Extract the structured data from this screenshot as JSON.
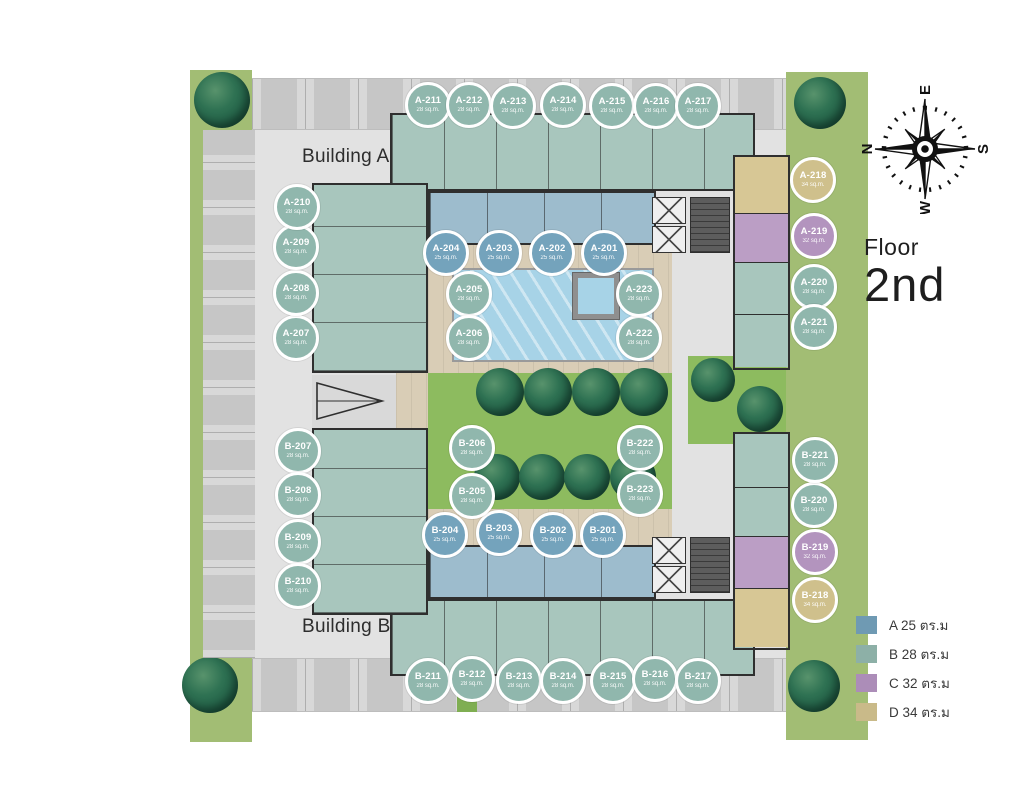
{
  "floor_label": {
    "line1": "Floor",
    "line2": "2nd"
  },
  "buildings": {
    "building_a": "Building A",
    "building_b": "Building B"
  },
  "compass": {
    "n": "N",
    "e": "E",
    "s": "S",
    "w": "W"
  },
  "legend": [
    {
      "code": "A",
      "label": "A 25 ตร.ม",
      "color": "#6f9ab3"
    },
    {
      "code": "B",
      "label": "B 28 ตร.ม",
      "color": "#8db0a7"
    },
    {
      "code": "C",
      "label": "C 32 ตร.ม",
      "color": "#ac8db8"
    },
    {
      "code": "D",
      "label": "D 34 ตร.ม",
      "color": "#c9ba89"
    }
  ],
  "unit_types": {
    "A": {
      "area": "25 sq.m.",
      "color": "#74a3bc"
    },
    "B": {
      "area": "28 sq.m.",
      "color": "#90b7ad"
    },
    "C": {
      "area": "32 sq.m.",
      "color": "#b394be"
    },
    "D": {
      "area": "34 sq.m.",
      "color": "#cfc08c"
    }
  },
  "units": [
    {
      "id": "A-201",
      "type": "A",
      "x": 604,
      "y": 253
    },
    {
      "id": "A-202",
      "type": "A",
      "x": 552,
      "y": 253
    },
    {
      "id": "A-203",
      "type": "A",
      "x": 499,
      "y": 253
    },
    {
      "id": "A-204",
      "type": "A",
      "x": 446,
      "y": 253
    },
    {
      "id": "A-205",
      "type": "B",
      "x": 469,
      "y": 294
    },
    {
      "id": "A-206",
      "type": "B",
      "x": 469,
      "y": 338
    },
    {
      "id": "A-207",
      "type": "B",
      "x": 296,
      "y": 338
    },
    {
      "id": "A-208",
      "type": "B",
      "x": 296,
      "y": 293
    },
    {
      "id": "A-209",
      "type": "B",
      "x": 296,
      "y": 247
    },
    {
      "id": "A-210",
      "type": "B",
      "x": 297,
      "y": 207
    },
    {
      "id": "A-211",
      "type": "B",
      "x": 428,
      "y": 105
    },
    {
      "id": "A-212",
      "type": "B",
      "x": 469,
      "y": 105
    },
    {
      "id": "A-213",
      "type": "B",
      "x": 513,
      "y": 106
    },
    {
      "id": "A-214",
      "type": "B",
      "x": 563,
      "y": 105
    },
    {
      "id": "A-215",
      "type": "B",
      "x": 612,
      "y": 106
    },
    {
      "id": "A-216",
      "type": "B",
      "x": 656,
      "y": 106
    },
    {
      "id": "A-217",
      "type": "B",
      "x": 698,
      "y": 106
    },
    {
      "id": "A-218",
      "type": "D",
      "x": 813,
      "y": 180
    },
    {
      "id": "A-219",
      "type": "C",
      "x": 814,
      "y": 236
    },
    {
      "id": "A-220",
      "type": "B",
      "x": 814,
      "y": 287
    },
    {
      "id": "A-221",
      "type": "B",
      "x": 814,
      "y": 327
    },
    {
      "id": "A-222",
      "type": "B",
      "x": 639,
      "y": 338
    },
    {
      "id": "A-223",
      "type": "B",
      "x": 639,
      "y": 294
    },
    {
      "id": "B-201",
      "type": "A",
      "x": 603,
      "y": 535
    },
    {
      "id": "B-202",
      "type": "A",
      "x": 553,
      "y": 535
    },
    {
      "id": "B-203",
      "type": "A",
      "x": 499,
      "y": 533
    },
    {
      "id": "B-204",
      "type": "A",
      "x": 445,
      "y": 535
    },
    {
      "id": "B-205",
      "type": "B",
      "x": 472,
      "y": 496
    },
    {
      "id": "B-206",
      "type": "B",
      "x": 472,
      "y": 448
    },
    {
      "id": "B-207",
      "type": "B",
      "x": 298,
      "y": 451
    },
    {
      "id": "B-208",
      "type": "B",
      "x": 298,
      "y": 495
    },
    {
      "id": "B-209",
      "type": "B",
      "x": 298,
      "y": 542
    },
    {
      "id": "B-210",
      "type": "B",
      "x": 298,
      "y": 586
    },
    {
      "id": "B-211",
      "type": "B",
      "x": 428,
      "y": 681
    },
    {
      "id": "B-212",
      "type": "B",
      "x": 472,
      "y": 679
    },
    {
      "id": "B-213",
      "type": "B",
      "x": 519,
      "y": 681
    },
    {
      "id": "B-214",
      "type": "B",
      "x": 563,
      "y": 681
    },
    {
      "id": "B-215",
      "type": "B",
      "x": 613,
      "y": 681
    },
    {
      "id": "B-216",
      "type": "B",
      "x": 655,
      "y": 679
    },
    {
      "id": "B-217",
      "type": "B",
      "x": 698,
      "y": 681
    },
    {
      "id": "B-218",
      "type": "D",
      "x": 815,
      "y": 600
    },
    {
      "id": "B-219",
      "type": "C",
      "x": 815,
      "y": 552
    },
    {
      "id": "B-220",
      "type": "B",
      "x": 814,
      "y": 505
    },
    {
      "id": "B-221",
      "type": "B",
      "x": 815,
      "y": 460
    },
    {
      "id": "B-222",
      "type": "B",
      "x": 640,
      "y": 448
    },
    {
      "id": "B-223",
      "type": "B",
      "x": 640,
      "y": 494
    }
  ]
}
